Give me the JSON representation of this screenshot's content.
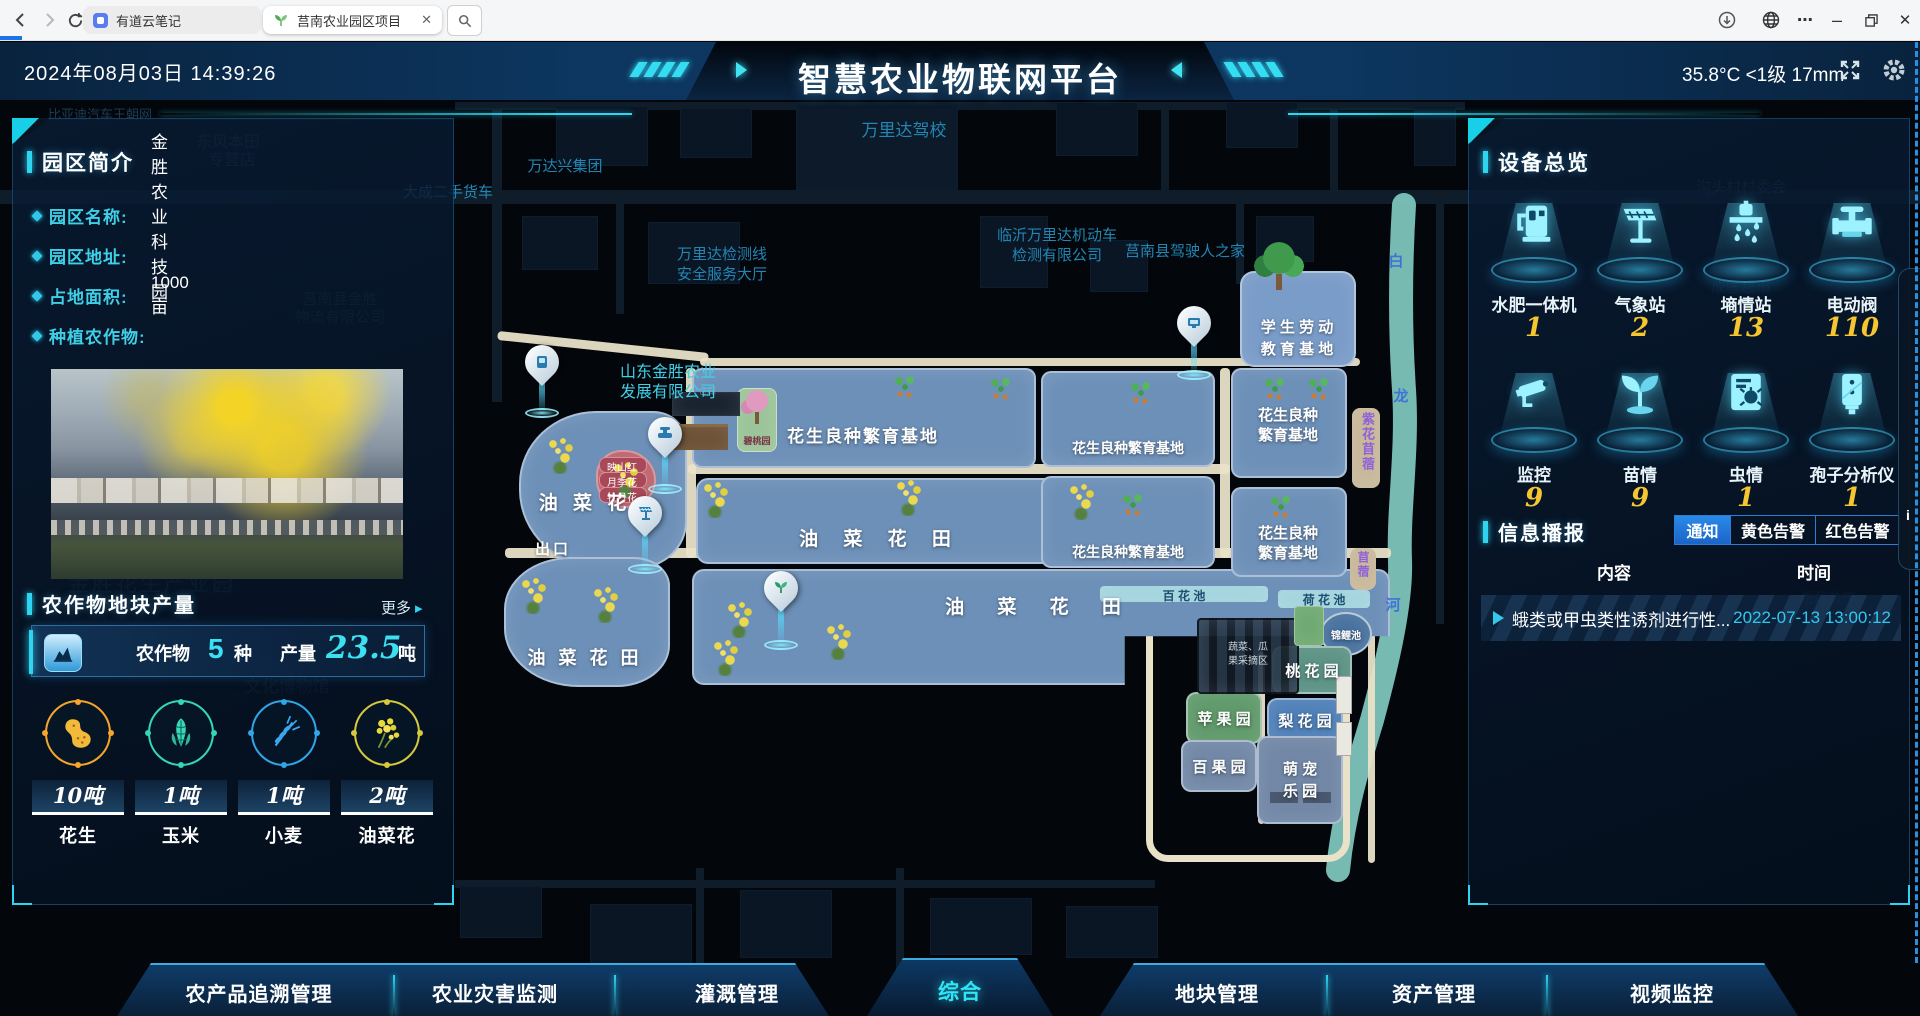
{
  "browser": {
    "tabs": [
      {
        "title": "有道云笔记"
      },
      {
        "title": "莒南农业园区项目"
      }
    ]
  },
  "header": {
    "date": "2024年08月03日 14:39:26",
    "title": "智慧农业物联网平台",
    "weather": "35.8°C <1级 17mm"
  },
  "park": {
    "title": "园区简介",
    "fields": [
      {
        "label": "园区名称:",
        "value": "金胜农业科技园"
      },
      {
        "label": "园区地址:",
        "value": ""
      },
      {
        "label": "占地面积:",
        "value": "1000亩"
      },
      {
        "label": "种植农作物:",
        "value": ""
      }
    ]
  },
  "crops": {
    "title": "农作物地块产量",
    "more": "更多",
    "more_arrow": "▸",
    "stat": {
      "crops_label": "农作物",
      "crops_value": "5",
      "crops_unit": "种",
      "yield_label": "产量",
      "yield_value": "23.5",
      "yield_unit": "吨"
    },
    "items": [
      {
        "name": "花生",
        "amount": "10吨",
        "color": "#f5a52b"
      },
      {
        "name": "玉米",
        "amount": "1吨",
        "color": "#35d6b5"
      },
      {
        "name": "小麦",
        "amount": "1吨",
        "color": "#2ea6e8"
      },
      {
        "name": "油菜花",
        "amount": "2吨",
        "color": "#d6c93e"
      }
    ]
  },
  "devices": {
    "title": "设备总览",
    "items": [
      {
        "label": "水肥一体机",
        "value": "1"
      },
      {
        "label": "气象站",
        "value": "2"
      },
      {
        "label": "墒情站",
        "value": "13"
      },
      {
        "label": "电动阀",
        "value": "110"
      },
      {
        "label": "监控",
        "value": "9"
      },
      {
        "label": "苗情",
        "value": "9"
      },
      {
        "label": "虫情",
        "value": "1"
      },
      {
        "label": "孢子分析仪",
        "value": "1"
      }
    ],
    "number_color": "#f5c62f",
    "icon_color": "#9df2ff"
  },
  "broadcast": {
    "title": "信息播报",
    "tabs": [
      {
        "label": "通知"
      },
      {
        "label": "黄色告警"
      },
      {
        "label": "红色告警"
      }
    ],
    "active_tab": "通知",
    "columns": [
      "内容",
      "时间"
    ],
    "rows": [
      {
        "content": "蛾类或甲虫类性诱剂进行性...",
        "time": "2022-07-13 13:00:12"
      }
    ],
    "time_color": "#2fc8f0"
  },
  "nav": {
    "active": "综合",
    "tabs": [
      {
        "label": "农产品追溯管理"
      },
      {
        "label": "农业灾害监测"
      },
      {
        "label": "灌溉管理"
      },
      {
        "label": "综合"
      },
      {
        "label": "地块管理"
      },
      {
        "label": "资产管理"
      },
      {
        "label": "视频监控"
      }
    ]
  },
  "edge": {
    "label": "i"
  },
  "theme": {
    "accent": "#2fd4f0",
    "panel_border": "#2a70aa",
    "alert_yellow": "#f5c62f"
  },
  "map": {
    "labels": [
      {
        "t": "万里达驾校"
      },
      {
        "t": "万达兴集团"
      },
      {
        "t": "大成二手货车"
      },
      {
        "t": "万里达检测线"
      },
      {
        "t": "安全服务大厅"
      },
      {
        "t": "临沂万里达机动车"
      },
      {
        "t": "检测有限公司"
      },
      {
        "t": "莒南县驾驶人之家"
      },
      {
        "t": "山东金胜农业"
      },
      {
        "t": "发展有限公司"
      },
      {
        "t": "东风本田"
      },
      {
        "t": "专营店"
      },
      {
        "t": "莒南县金胜"
      },
      {
        "t": "物流有限公司"
      },
      {
        "t": "金胜花生产业园"
      },
      {
        "t": "金胜花生"
      },
      {
        "t": "文化博物馆"
      },
      {
        "t": "沟头村村委会"
      },
      {
        "t": "成匡超市"
      },
      {
        "t": "煜翔装饰"
      },
      {
        "t": "装饰"
      },
      {
        "t": "比亚迪汽车王朝网"
      },
      {
        "t": "出口"
      },
      {
        "t": "仓库"
      },
      {
        "t": "白"
      },
      {
        "t": "龙"
      },
      {
        "t": "河"
      },
      {
        "t": "油 菜 花"
      },
      {
        "t": "油 菜 花 田"
      },
      {
        "t": "油 菜 花 田"
      },
      {
        "t": "油 菜 花 田"
      },
      {
        "t": "花生良种繁育基地"
      },
      {
        "t": "花生良种繁育基地"
      },
      {
        "t": "花生良种繁育基地"
      },
      {
        "t": "花生良种"
      },
      {
        "t": "繁育基地"
      },
      {
        "t": "花生良种"
      },
      {
        "t": "繁育基地"
      },
      {
        "t": "学 生 劳 动"
      },
      {
        "t": "教 育 基 地"
      },
      {
        "t": "百 花 池"
      },
      {
        "t": "荷 花 池"
      },
      {
        "t": "锦鲤池"
      },
      {
        "t": "桃 花 园"
      },
      {
        "t": "苹 果 园"
      },
      {
        "t": "梨 花 园"
      },
      {
        "t": "百 果 园"
      },
      {
        "t": "萌 宠"
      },
      {
        "t": "乐 园"
      },
      {
        "t": "蔬菜、瓜"
      },
      {
        "t": "果采摘区"
      },
      {
        "t": "紫花苜蓿"
      },
      {
        "t": "苜蓿"
      },
      {
        "t": "碧桃园"
      },
      {
        "t": "映山红"
      },
      {
        "t": "月季花"
      },
      {
        "t": "牡丹花"
      }
    ]
  }
}
